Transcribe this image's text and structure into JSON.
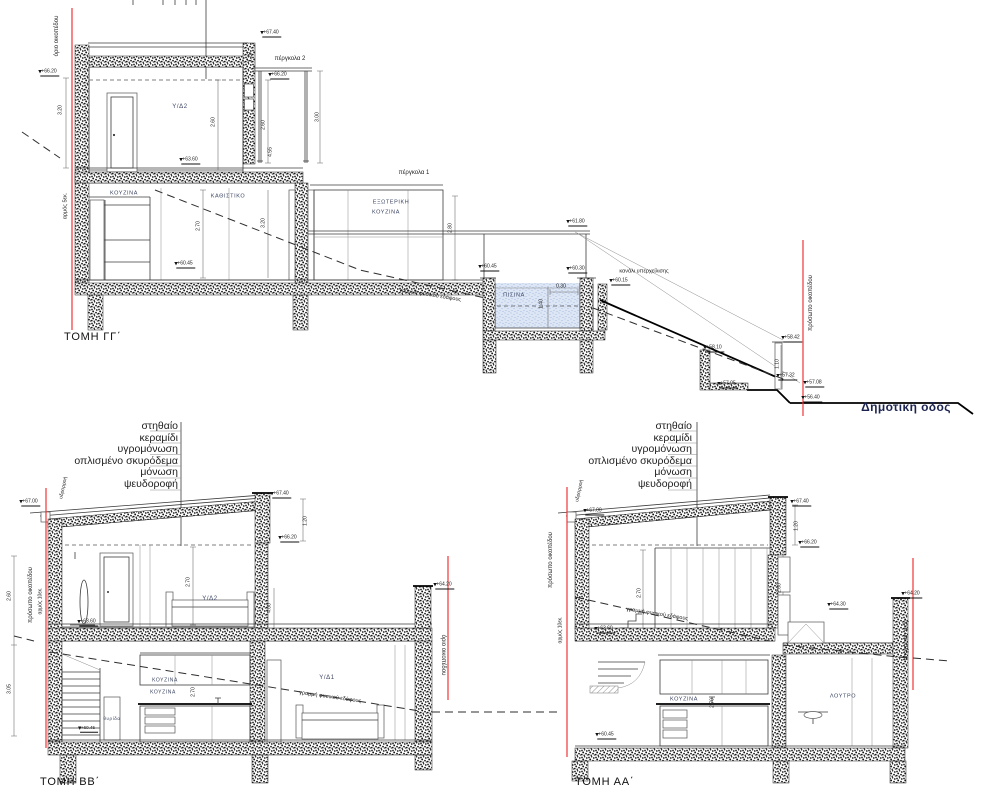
{
  "drawing": {
    "titles": {
      "gg": "ΤΟΜΗ ΓΓ΄",
      "bb": "ΤΟΜΗ ΒΒ΄",
      "aa": "ΤΟΜΗ ΑΑ΄"
    },
    "roof_callout": [
      "στηθαίο",
      "κεραμίδι",
      "υγρομόνωση",
      "οπλισμένο σκυρόδεμα",
      "μόνωση",
      "ψευδοροφή"
    ],
    "colors": {
      "boundary_red": "#f23535",
      "pool_water": "#dce6f5",
      "room_label": "#3c4663"
    },
    "labels": [
      {
        "n": "boundary-label",
        "t": "όριο οικοπέδου",
        "x": 57,
        "y": 36,
        "r": -90,
        "s": 6
      },
      {
        "n": "level-label",
        "t": "+66.20",
        "x": 50,
        "y": 73,
        "s": 5,
        "m": 1
      },
      {
        "n": "dimension-label",
        "t": "3.20",
        "x": 61,
        "y": 110,
        "r": -90,
        "s": 5
      },
      {
        "n": "level-label",
        "t": "+67.40",
        "x": 272,
        "y": 34,
        "s": 5,
        "m": 1
      },
      {
        "n": "pergola-label",
        "t": "πέργκολα 2",
        "x": 290,
        "y": 59,
        "s": 6
      },
      {
        "n": "level-label",
        "t": "+66.20",
        "x": 280,
        "y": 76,
        "s": 5,
        "m": 1
      },
      {
        "n": "dimension-label",
        "t": "1.20",
        "x": 251,
        "y": 57,
        "r": -90,
        "s": 5
      },
      {
        "n": "dimension-label",
        "t": "3.00",
        "x": 318,
        "y": 117,
        "r": -90,
        "s": 5
      },
      {
        "n": "room-label",
        "t": "Υ/Δ2",
        "x": 180,
        "y": 107,
        "s": 6,
        "c": "room"
      },
      {
        "n": "dimension-label",
        "t": "2.60",
        "x": 214,
        "y": 122,
        "r": -90,
        "s": 5
      },
      {
        "n": "dimension-label",
        "t": "2.60",
        "x": 264,
        "y": 125,
        "r": -90,
        "s": 5
      },
      {
        "n": "dimension-label",
        "t": "4.55",
        "x": 271,
        "y": 152,
        "r": -90,
        "s": 5
      },
      {
        "n": "level-label",
        "t": "+63.60",
        "x": 191,
        "y": 161,
        "s": 5,
        "m": 1
      },
      {
        "n": "room-label",
        "t": "ΚΟΥΖΙΝΑ",
        "x": 124,
        "y": 194,
        "s": 5.5,
        "c": "room"
      },
      {
        "n": "room-label",
        "t": "ΚΑΘΙΣΤΙΚΟ",
        "x": 228,
        "y": 197,
        "s": 5.5,
        "c": "room"
      },
      {
        "n": "pergola-label",
        "t": "πέργκολα 1",
        "x": 414,
        "y": 173,
        "s": 6
      },
      {
        "n": "room-label",
        "t": "ΕΞΩΤΕΡΙΚΗ",
        "x": 391,
        "y": 203,
        "s": 5.5,
        "c": "room"
      },
      {
        "n": "room-label",
        "t": "ΚΟΥΖΙΝΑ",
        "x": 386,
        "y": 213,
        "s": 5.5,
        "c": "room"
      },
      {
        "n": "dimension-label",
        "t": "2.70",
        "x": 199,
        "y": 226,
        "r": -90,
        "s": 5
      },
      {
        "n": "dimension-label",
        "t": "3.20",
        "x": 264,
        "y": 223,
        "r": -90,
        "s": 5
      },
      {
        "n": "dimension-label",
        "t": "2.80",
        "x": 451,
        "y": 228,
        "r": -90,
        "s": 5
      },
      {
        "n": "level-label",
        "t": "+60.45",
        "x": 186,
        "y": 265,
        "s": 5,
        "m": 1
      },
      {
        "n": "level-label",
        "t": "+61.80",
        "x": 578,
        "y": 223,
        "s": 5,
        "m": 1
      },
      {
        "n": "level-label",
        "t": "+60.45",
        "x": 490,
        "y": 268,
        "s": 5,
        "m": 1
      },
      {
        "n": "level-label",
        "t": "+60.30",
        "x": 578,
        "y": 270,
        "s": 5,
        "m": 1
      },
      {
        "n": "note-label",
        "t": "κανάλι υπερχείλισης",
        "x": 644,
        "y": 272,
        "s": 5.5
      },
      {
        "n": "level-label",
        "t": "+60.15",
        "x": 621,
        "y": 282,
        "s": 5,
        "m": 1
      },
      {
        "n": "room-label",
        "t": "ΠΙΣΙΝΑ",
        "x": 514,
        "y": 296,
        "s": 5.5,
        "c": "room"
      },
      {
        "n": "dimension-label",
        "t": "0.30",
        "x": 561,
        "y": 287,
        "s": 5
      },
      {
        "n": "dimension-label",
        "t": "1.40",
        "x": 542,
        "y": 304,
        "r": -90,
        "s": 5
      },
      {
        "n": "note-label",
        "t": "γραμμή φυσικού εδάφους",
        "x": 430,
        "y": 296,
        "r": 9,
        "s": 5.5
      },
      {
        "n": "note-label",
        "t": "αρμός 5εκ.",
        "x": 66,
        "y": 206,
        "r": -90,
        "s": 5.5
      },
      {
        "n": "level-label",
        "t": "+58.42",
        "x": 793,
        "y": 339,
        "s": 5,
        "m": 1
      },
      {
        "n": "level-label",
        "t": "+58.10",
        "x": 715,
        "y": 349,
        "s": 5,
        "m": 1
      },
      {
        "n": "dimension-label",
        "t": "1.10",
        "x": 778,
        "y": 364,
        "r": -90,
        "s": 5
      },
      {
        "n": "level-label",
        "t": "+57.32",
        "x": 788,
        "y": 377,
        "s": 5,
        "m": 1
      },
      {
        "n": "level-label",
        "t": "+57.08",
        "x": 815,
        "y": 384,
        "s": 5,
        "m": 1
      },
      {
        "n": "level-label",
        "t": "+57.05",
        "x": 729,
        "y": 385,
        "s": 5,
        "m": 1
      },
      {
        "n": "level-label",
        "t": "+56.40",
        "x": 813,
        "y": 399,
        "s": 5,
        "m": 1
      },
      {
        "n": "boundary-label",
        "t": "πρόσωπο οικοπέδου",
        "x": 811,
        "y": 303,
        "r": -90,
        "s": 6
      },
      {
        "n": "road-label",
        "t": "Δημοτική οδός",
        "x": 906,
        "y": 407,
        "s": 12,
        "c": "road"
      },
      {
        "n": "note-label",
        "t": "υδρορροή",
        "x": 64,
        "y": 488,
        "r": -78,
        "s": 5
      },
      {
        "n": "level-label",
        "t": "+67.00",
        "x": 31,
        "y": 503,
        "s": 5,
        "m": 1
      },
      {
        "n": "level-label",
        "t": "+67.40",
        "x": 282,
        "y": 495,
        "s": 5,
        "m": 1
      },
      {
        "n": "dimension-label",
        "t": "1.20",
        "x": 306,
        "y": 521,
        "r": -90,
        "s": 5
      },
      {
        "n": "level-label",
        "t": "+66.20",
        "x": 290,
        "y": 539,
        "s": 5,
        "m": 1
      },
      {
        "n": "room-label",
        "t": "Υ/Δ2",
        "x": 210,
        "y": 599,
        "s": 6,
        "c": "room"
      },
      {
        "n": "dimension-label",
        "t": "2.70",
        "x": 189,
        "y": 582,
        "r": -90,
        "s": 5
      },
      {
        "n": "level-label",
        "t": "+63.60",
        "x": 89,
        "y": 623,
        "s": 5,
        "m": 1
      },
      {
        "n": "level-label",
        "t": "+64.20",
        "x": 445,
        "y": 586,
        "s": 5,
        "m": 1
      },
      {
        "n": "dimension-label",
        "t": "4.00",
        "x": 270,
        "y": 608,
        "r": -90,
        "s": 5
      },
      {
        "n": "room-label",
        "t": "Υ/Δ1",
        "x": 327,
        "y": 678,
        "s": 6,
        "c": "room"
      },
      {
        "n": "note-label",
        "t": "γραμμή φυσικού εδάφους",
        "x": 330,
        "y": 698,
        "r": 8,
        "s": 5.5
      },
      {
        "n": "boundary-label",
        "t": "όριο οικοπέδου",
        "x": 443,
        "y": 655,
        "r": 90,
        "s": 6
      },
      {
        "n": "room-label",
        "t": "ΚΟΥΖΙΝΑ",
        "x": 165,
        "y": 681,
        "s": 5,
        "c": "room"
      },
      {
        "n": "room-label",
        "t": "ΚΟΥΖΙΝΑ",
        "x": 163,
        "y": 693,
        "s": 5,
        "c": "room"
      },
      {
        "n": "dimension-label",
        "t": "2.70",
        "x": 194,
        "y": 692,
        "r": -90,
        "s": 5
      },
      {
        "n": "room-label",
        "t": "θυρίδα",
        "x": 112,
        "y": 719,
        "s": 4.5,
        "c": "room"
      },
      {
        "n": "level-label",
        "t": "+60.45",
        "x": 89,
        "y": 729,
        "s": 4.5,
        "m": 1
      },
      {
        "n": "dimension-label",
        "t": "2.60",
        "x": 10,
        "y": 596,
        "r": -90,
        "s": 5
      },
      {
        "n": "dimension-label",
        "t": "3.05",
        "x": 10,
        "y": 689,
        "r": -90,
        "s": 5
      },
      {
        "n": "boundary-label",
        "t": "πρόσωπο οικοπέδου",
        "x": 31,
        "y": 595,
        "r": -90,
        "s": 6
      },
      {
        "n": "note-label",
        "t": "αρμός 10εκ.",
        "x": 41,
        "y": 601,
        "r": -90,
        "s": 5
      },
      {
        "n": "note-label",
        "t": "υδρορροή",
        "x": 580,
        "y": 491,
        "r": -78,
        "s": 5
      },
      {
        "n": "level-label",
        "t": "+67.00",
        "x": 595,
        "y": 512,
        "s": 5,
        "m": 1
      },
      {
        "n": "level-label",
        "t": "+67.40",
        "x": 802,
        "y": 503,
        "s": 5,
        "m": 1
      },
      {
        "n": "dimension-label",
        "t": "1.20",
        "x": 797,
        "y": 526,
        "r": -90,
        "s": 5
      },
      {
        "n": "level-label",
        "t": "+66.20",
        "x": 810,
        "y": 544,
        "s": 5,
        "m": 1
      },
      {
        "n": "dimension-label",
        "t": "2.60",
        "x": 780,
        "y": 588,
        "r": -90,
        "s": 5
      },
      {
        "n": "dimension-label",
        "t": "2.70",
        "x": 640,
        "y": 593,
        "r": -90,
        "s": 5
      },
      {
        "n": "note-label",
        "t": "γραμμή φυσικού εδάφους",
        "x": 657,
        "y": 615,
        "r": 9,
        "s": 5.5
      },
      {
        "n": "level-label",
        "t": "+63.60",
        "x": 606,
        "y": 630,
        "s": 5,
        "m": 1
      },
      {
        "n": "level-label",
        "t": "+64.30",
        "x": 839,
        "y": 606,
        "s": 5,
        "m": 1
      },
      {
        "n": "level-label",
        "t": "+64.20",
        "x": 913,
        "y": 595,
        "s": 5,
        "m": 1
      },
      {
        "n": "boundary-label",
        "t": "όριο οικοπέδου",
        "x": 905,
        "y": 640,
        "r": 90,
        "s": 6
      },
      {
        "n": "room-label",
        "t": "ΚΟΥΖΙΝΑ",
        "x": 684,
        "y": 700,
        "s": 5.5,
        "c": "room"
      },
      {
        "n": "dimension-label",
        "t": "2.70",
        "x": 713,
        "y": 703,
        "r": -90,
        "s": 5
      },
      {
        "n": "room-label",
        "t": "ΛΟΥΤΡΟ",
        "x": 843,
        "y": 697,
        "s": 5.5,
        "c": "room"
      },
      {
        "n": "level-label",
        "t": "+60.45",
        "x": 607,
        "y": 736,
        "s": 5,
        "m": 1
      },
      {
        "n": "boundary-label",
        "t": "πρόσωπο οικοπέδου",
        "x": 551,
        "y": 560,
        "r": -90,
        "s": 6
      },
      {
        "n": "note-label",
        "t": "αρμός 10εκ.",
        "x": 561,
        "y": 630,
        "r": -90,
        "s": 5
      }
    ]
  }
}
